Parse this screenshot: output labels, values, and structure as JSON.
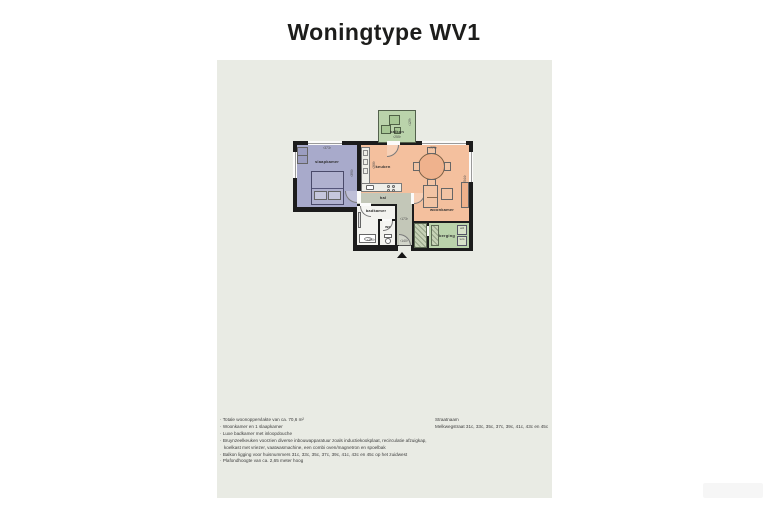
{
  "page": {
    "title": "Woningtype WV1"
  },
  "colors": {
    "panel_bg": "#e9ebe4",
    "wall": "#1c1c1c",
    "slaapkamer": "#a8aacb",
    "woonkeuken": "#f4c09e",
    "hal": "#c3c7b8",
    "badkamer": "#f3f3ef",
    "groen": "#bad3ab"
  },
  "plan": {
    "rooms": {
      "balkon": {
        "label": "balkon"
      },
      "slaapkamer": {
        "label": "slaapkamer"
      },
      "keuken": {
        "label": "keuken"
      },
      "woonkamer": {
        "label": "woonkamer"
      },
      "hal": {
        "label": "hal"
      },
      "badkamer": {
        "label": "badkamer"
      },
      "wc": {
        "label": "wc"
      },
      "berging": {
        "label": "berging"
      }
    },
    "appliances": {
      "wd": "wd",
      "wm": "wm"
    },
    "dims": {
      "slaapkamer_w": "‹373›",
      "slaapkamer_h": "‹390›",
      "keuken_h": "‹266›",
      "woonkamer_w": "‹775›",
      "woonkamer_h": "‹544›",
      "balkon_w": "‹255›",
      "balkon_h": "‹129›",
      "badkamer_w": "‹190›",
      "hal_w": "‹173›",
      "entree_w": "‹140›"
    }
  },
  "notes": {
    "items": [
      "Totale woonoppervlakte van ca. 70,6 m²",
      "Woonkamer en 1 slaapkamer",
      "Luxe badkamer met inloopdouche",
      "Bruynzeelkeuken voorzien diverse inbouwapparatuur zoals inductiekookplaat, recirculatie afzuigkap, koelkast met vriezer, vaatwasmachine, een combi oven/magnetron en spoelbak",
      "Balkon ligging voor huisnummers 31c, 33c, 35c, 37c, 39c, 41c, 43c en 45c op het zuidwest",
      "Plafondhoogte van ca. 2,65 meter hoog"
    ]
  },
  "address": {
    "heading": "Straatnaam",
    "line": "Melkwegstraat 31c, 33c, 35c, 37c, 39c, 41c, 43c en 45c"
  }
}
